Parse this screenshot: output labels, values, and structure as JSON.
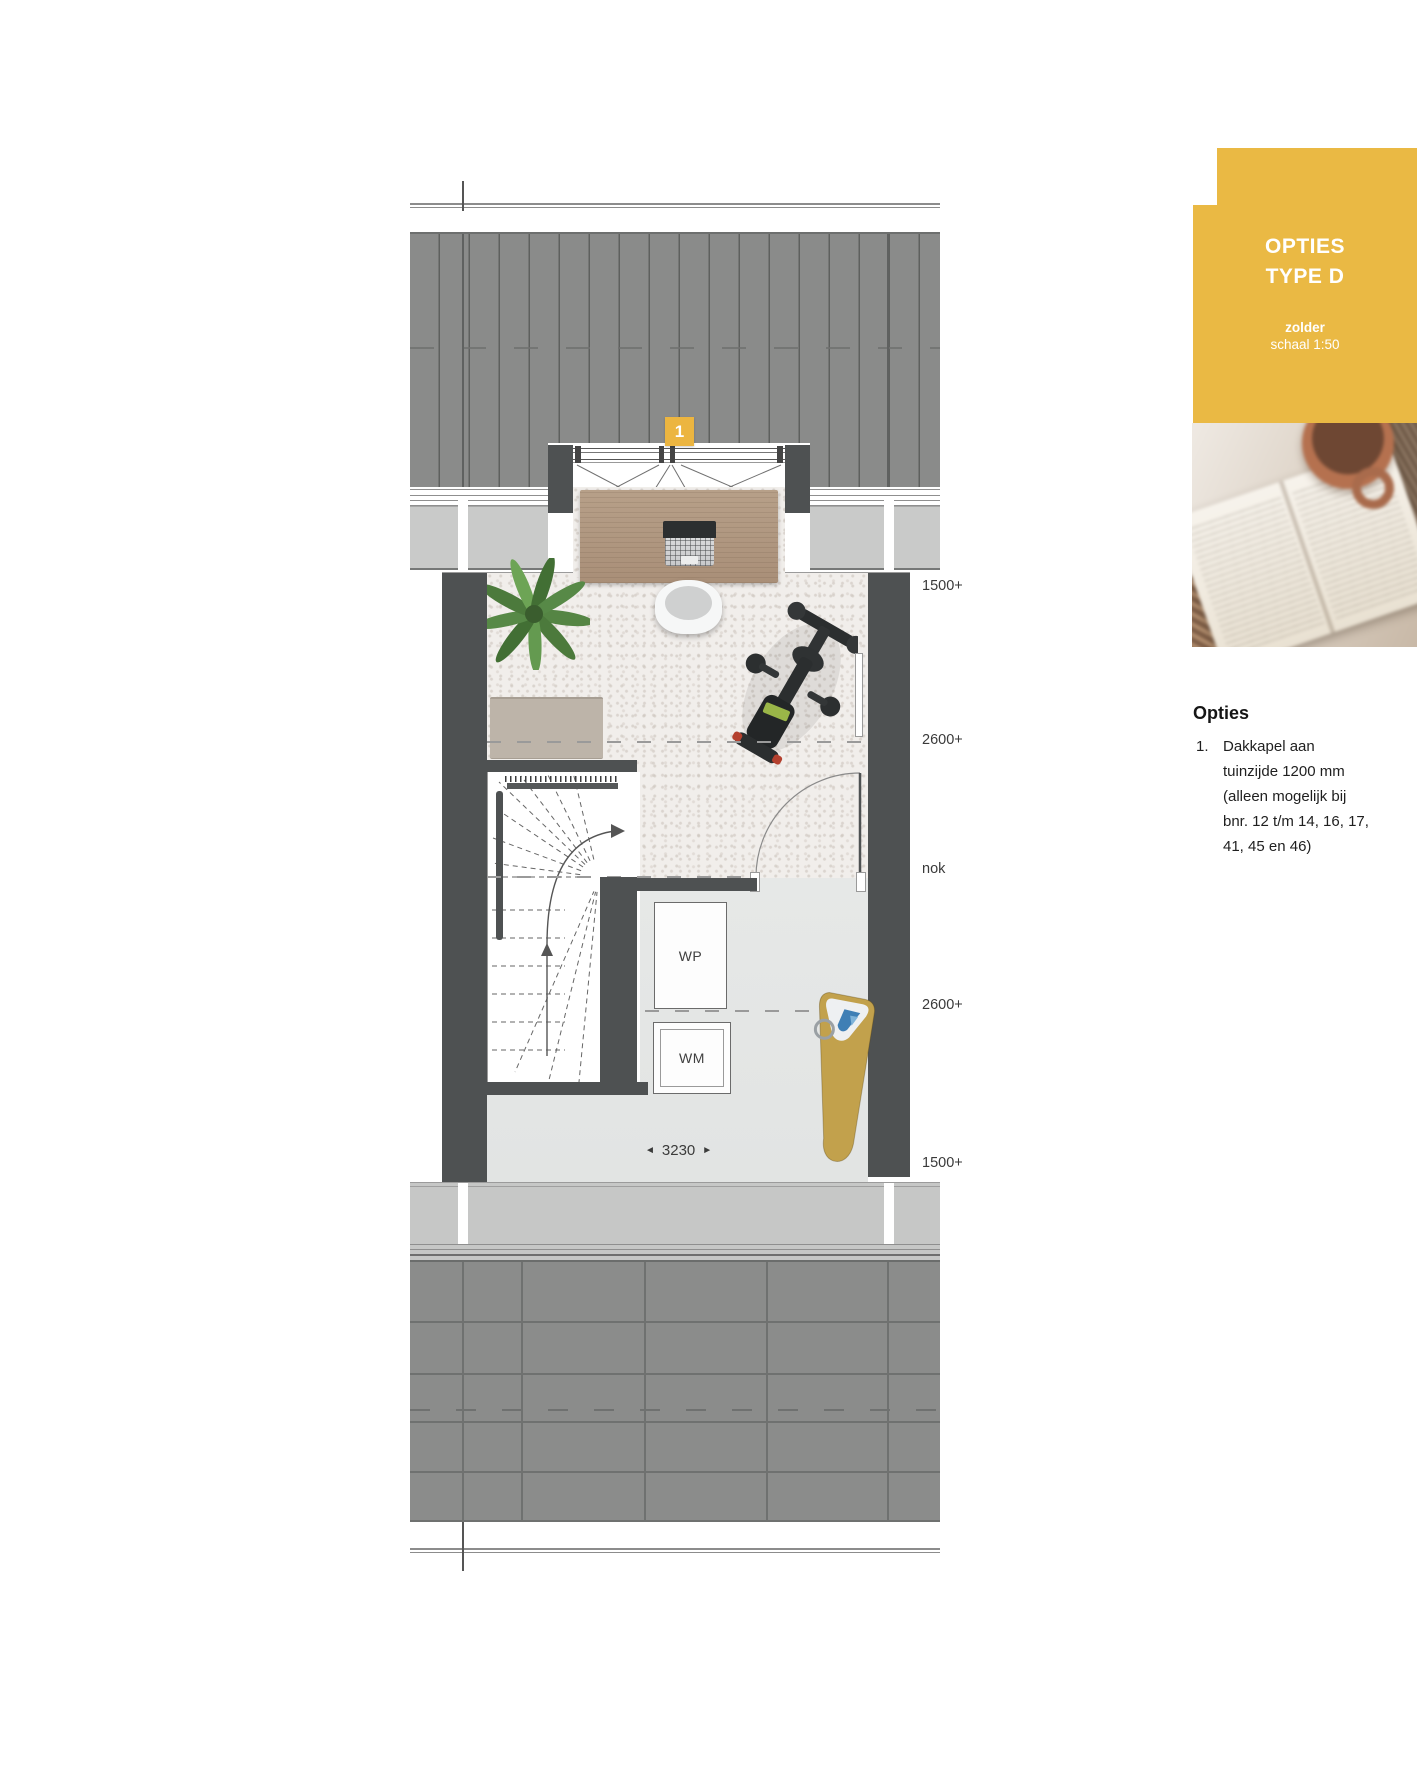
{
  "header_card": {
    "title_line1": "OPTIES",
    "title_line2": "TYPE D",
    "floor_label": "zolder",
    "scale_label": "schaal 1:50",
    "accent_color": "#eab944"
  },
  "options_section": {
    "heading": "Opties",
    "items": [
      {
        "number": "1.",
        "text": "Dakkapel aan tuinzijde 1200 mm (alleen mogelijk bij bnr. 12 t/m 14, 16, 17, 41, 45 en 46)"
      }
    ]
  },
  "floorplan": {
    "option_badge": "1",
    "appliance_labels": {
      "heat_pump": "WP",
      "washing_machine": "WM"
    },
    "width_dimension": {
      "left_arrow": "◄",
      "value": "3230",
      "right_arrow": "►"
    },
    "height_markers": [
      {
        "text": "1500+"
      },
      {
        "text": "2600+"
      },
      {
        "text": "nok"
      },
      {
        "text": "2600+"
      },
      {
        "text": "1500+"
      }
    ],
    "colors": {
      "roof": "#8a8b8a",
      "wall": "#4e5152",
      "eave": "#c9cac9",
      "carpet": "#f1eeeb",
      "laundry_floor": "#e4e6e5",
      "desk_wood": "#b29c86",
      "mat": "#bdb4a9",
      "ironing_board": "#c2a14c",
      "accent": "#eab944"
    }
  }
}
